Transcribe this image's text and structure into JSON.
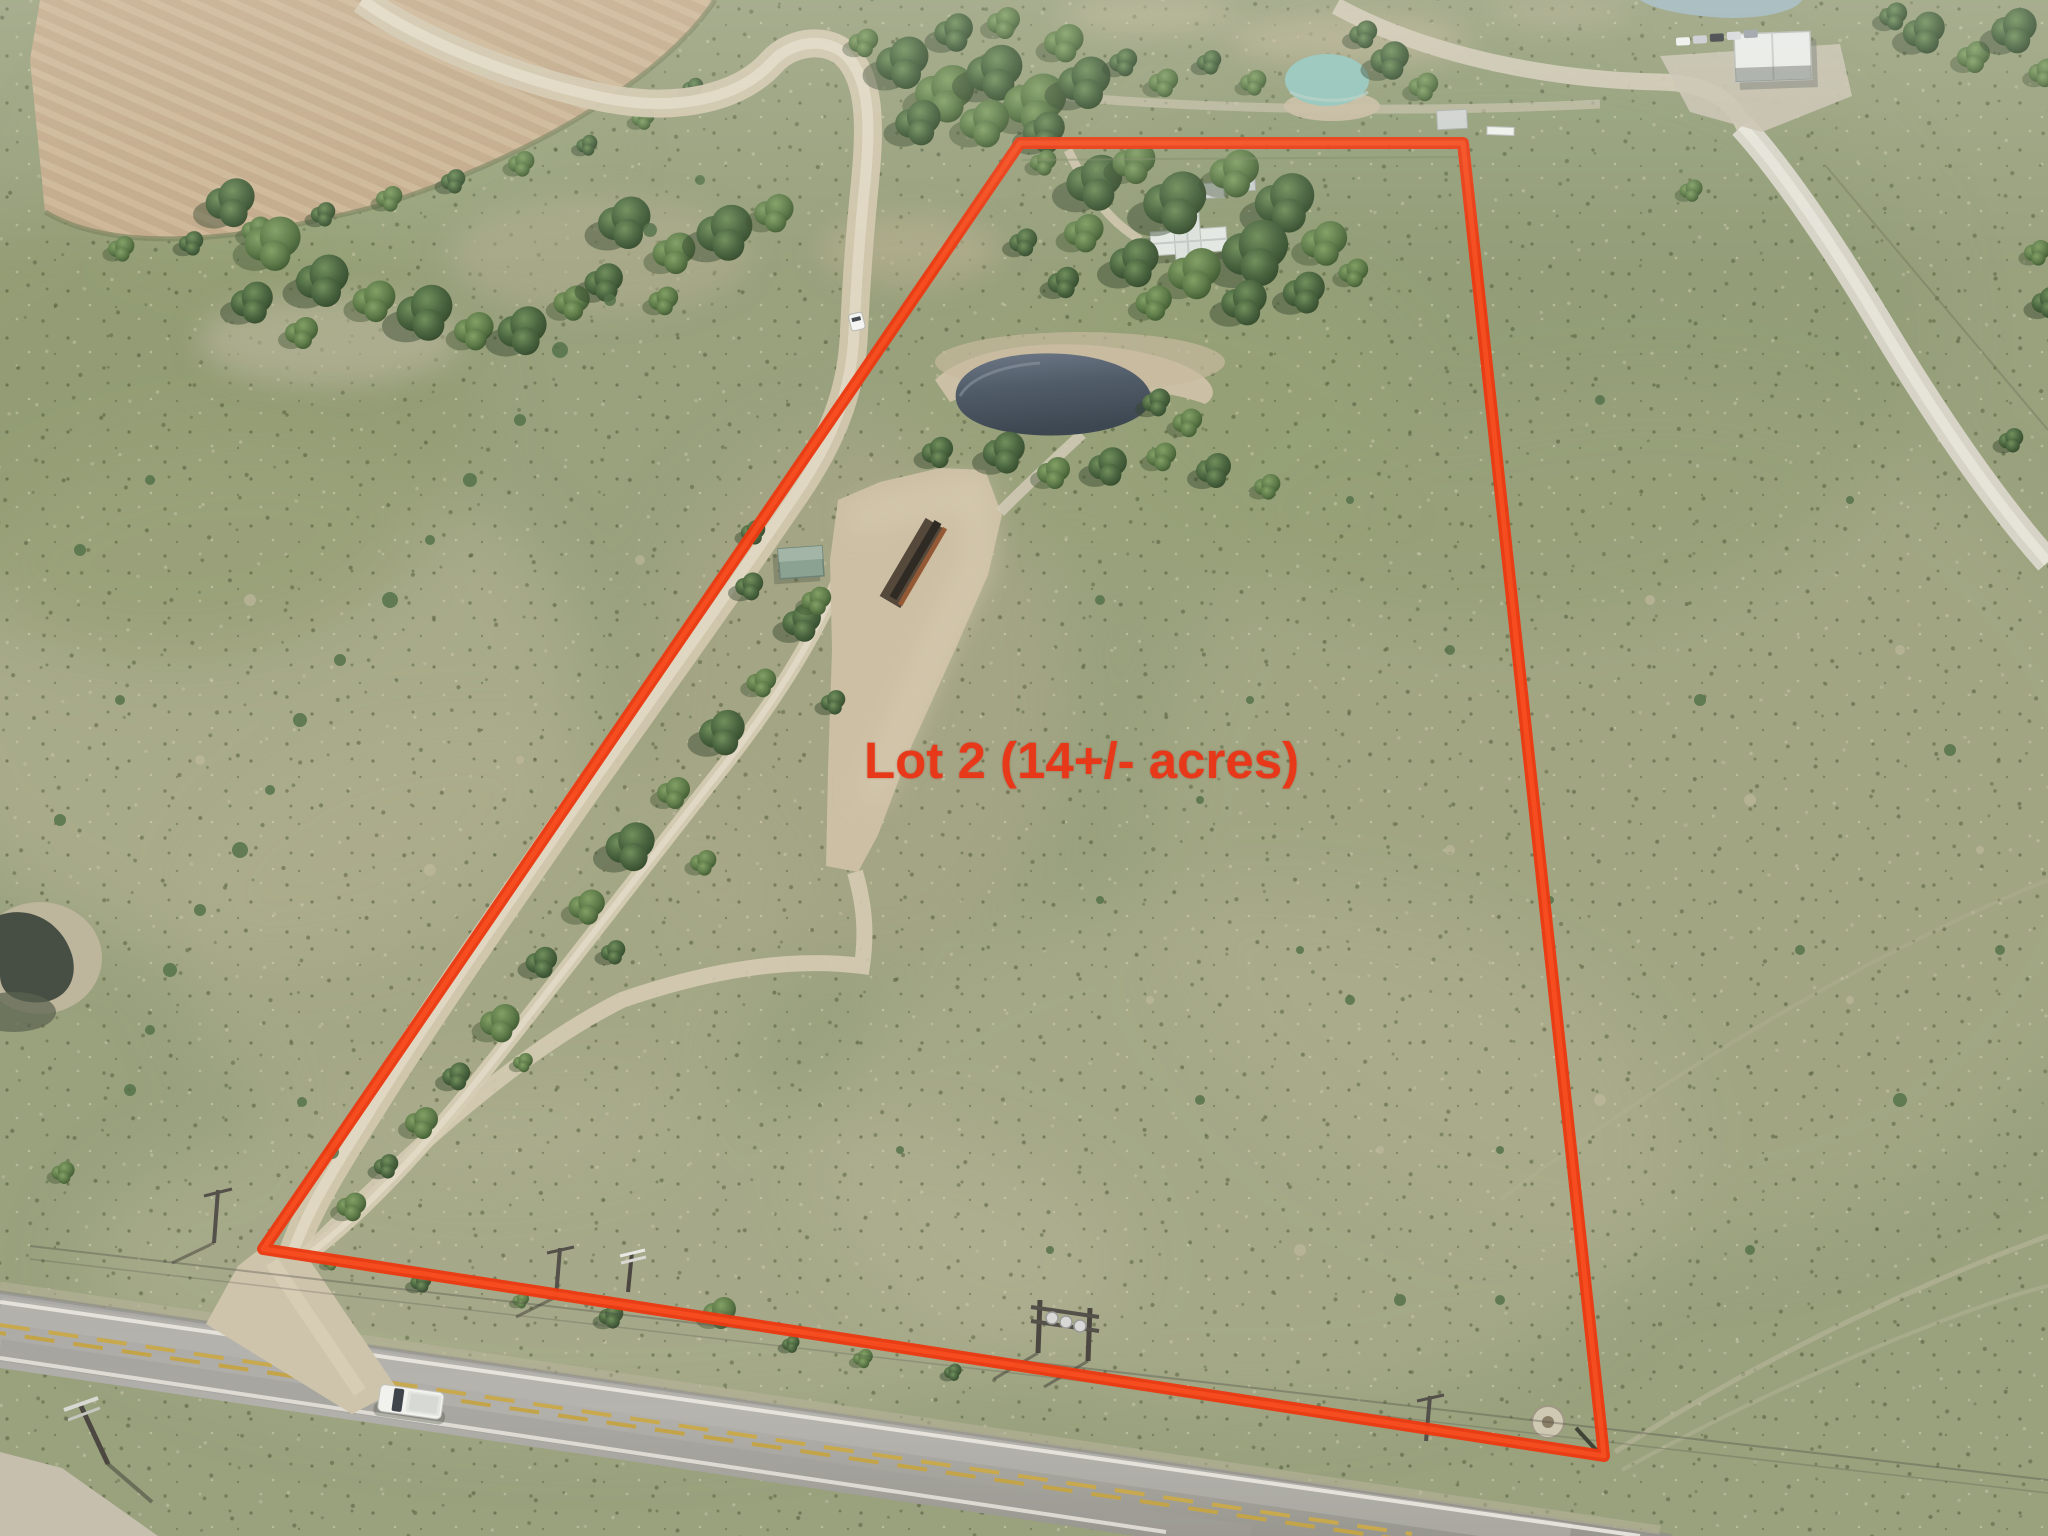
{
  "annotation": {
    "lot_label": "Lot 2 (14+/- acres)",
    "label_color": "#e8381a",
    "boundary_color": "#ea3a12",
    "boundary_points": "1020,143 1463,143 1604,1456 263,1249"
  },
  "scene": {
    "type": "aerial-drone-photo",
    "colors": {
      "pasture_green": "#99a17d",
      "dry_grass": "#b3b194",
      "plowed_field_tan": "#c4ac8c",
      "dirt_road_tan": "#d2c7ae",
      "asphalt_gray": "#a5a4a0",
      "pond_water_dark": "#4d5864",
      "stock_pond_turquoise": "#93c4ba",
      "tree_green_dark": "#46603a",
      "metal_roof_white": "#e9ebe7",
      "center_line_yellow": "#c9a94e"
    }
  }
}
